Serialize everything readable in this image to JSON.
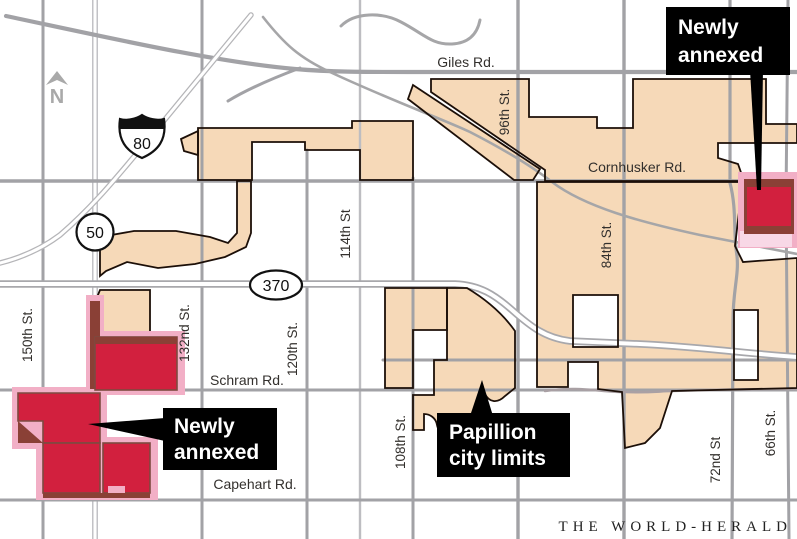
{
  "credit": "THE WORLD-HERALD",
  "north": "N",
  "shields": {
    "interstate_80": "80",
    "hwy_50": "50",
    "hwy_370": "370"
  },
  "roads": {
    "giles": "Giles Rd.",
    "cornhusker": "Cornhusker Rd.",
    "schram": "Schram Rd.",
    "capehart": "Capehart Rd.",
    "st150": "150th St.",
    "st132": "132nd St.",
    "st120": "120th St.",
    "st114": "114th St",
    "st108": "108th St.",
    "st96": "96th St.",
    "st84": "84th St.",
    "st72": "72nd St",
    "st66": "66th St."
  },
  "callouts": {
    "ne": {
      "line1": "Newly",
      "line2": "annexed"
    },
    "sw": {
      "line1": "Newly",
      "line2": "annexed"
    },
    "city": {
      "line1": "Papillion",
      "line2": "city limits"
    }
  },
  "colors": {
    "city_limits_fill": "#f6d9b8",
    "newly_annexed_red": "#d2203e",
    "annexed_dark_edge": "#8a4036",
    "annexed_pink_halo": "#f2afc6",
    "road_gray": "#a2a2a6",
    "boundary_black": "#1c0f08",
    "callout_bg": "#000000",
    "callout_text": "#ffffff"
  }
}
